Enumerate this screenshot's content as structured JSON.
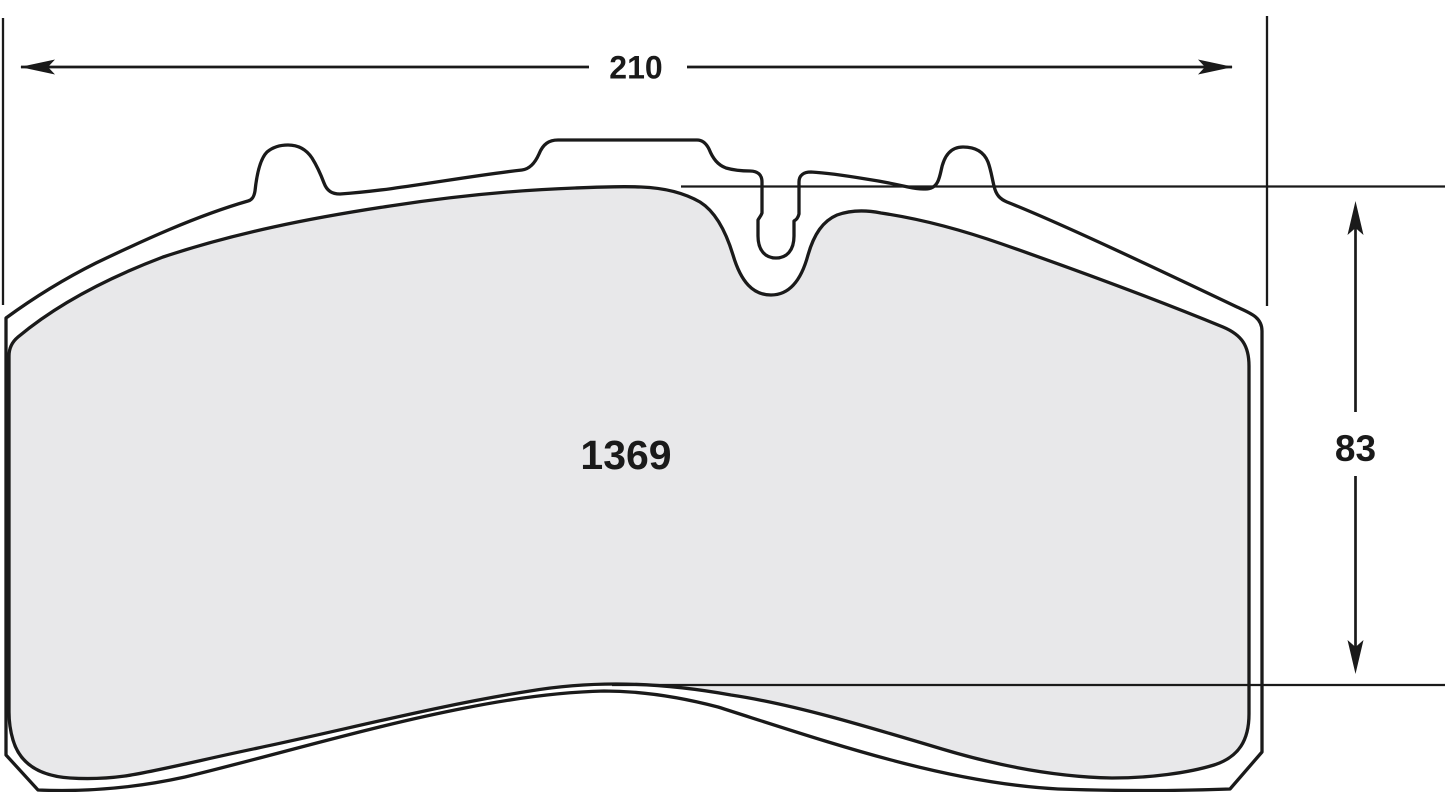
{
  "diagram": {
    "part_number": "1369",
    "dimensions": {
      "width": {
        "label": "210",
        "orientation": "horizontal"
      },
      "height": {
        "label": "83",
        "orientation": "vertical"
      }
    },
    "colors": {
      "line": "#1a1a1a",
      "friction_fill": "#e8e8ea",
      "backplate_fill": "#ffffff",
      "background": "#ffffff"
    }
  }
}
